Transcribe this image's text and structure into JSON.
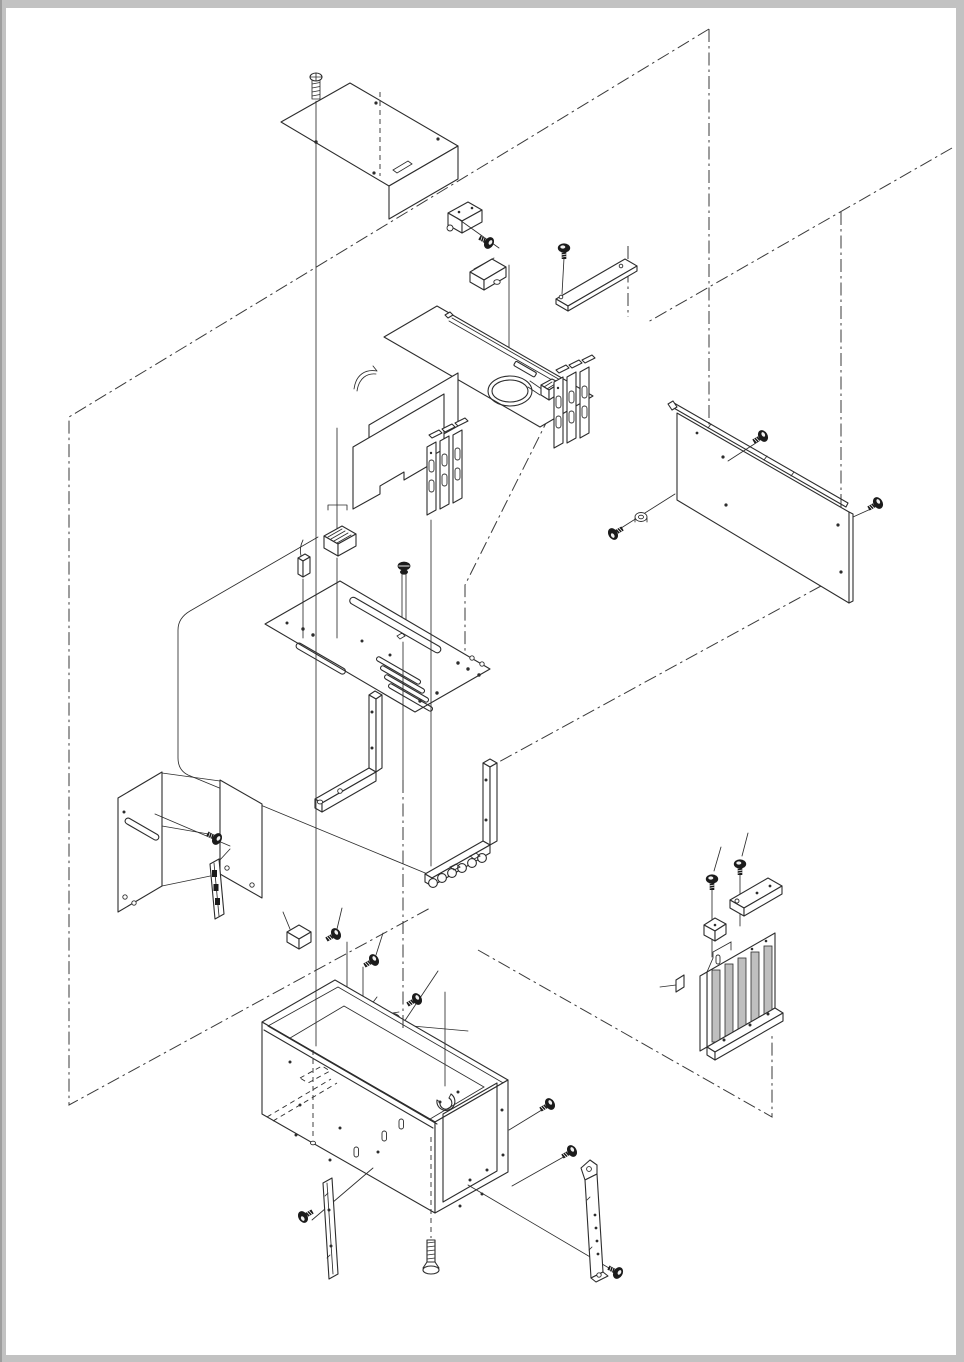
{
  "document": {
    "kind": "exploded-assembly-parts-diagram",
    "description": "black-and-white isometric exploded view of an electronics chassis assembly on a scanned white page",
    "visible_text": [],
    "page": {
      "width": 964,
      "height": 1362
    },
    "colors": {
      "page": "#ffffff",
      "margin": "#c2c2c2",
      "margin_edge": "#9e9e9e",
      "line": "#2d2d2d",
      "construction": "#3a3a3a",
      "slot_fill": "#bfbfbf",
      "screw_fill": "#1b1b1b"
    }
  },
  "parts": [
    {
      "id": "top-cover-screw",
      "name": "flat-head screw above top cover"
    },
    {
      "id": "top-cover-panel",
      "name": "top cover panel with bent flange"
    },
    {
      "id": "hinge-bracket",
      "name": "small hinge bracket with screw"
    },
    {
      "id": "small-cover-cap",
      "name": "small cover cap with grommet hole"
    },
    {
      "id": "top-rail-bracket",
      "name": "long angle rail with screw"
    },
    {
      "id": "right-side-panel",
      "name": "right side cover panel with edge rail and three screws"
    },
    {
      "id": "main-controller-board",
      "name": "controller board panel with cable loop"
    },
    {
      "id": "rear-slot-brackets",
      "name": "three rear connector slot brackets"
    },
    {
      "id": "expansion-cards",
      "name": "two expansion cards with slot brackets"
    },
    {
      "id": "ribbon-cable-connector",
      "name": "ribbon cable plug with pull tab"
    },
    {
      "id": "two-pin-connector",
      "name": "small two-pin connector"
    },
    {
      "id": "long-mount-screw",
      "name": "long mounting screw"
    },
    {
      "id": "slotted-base-tray",
      "name": "slotted mounting tray"
    },
    {
      "id": "left-angle-bracket",
      "name": "left L-shaped support bracket"
    },
    {
      "id": "right-angle-bracket",
      "name": "right L-shaped support bracket with cable chain"
    },
    {
      "id": "left-mount-bracket",
      "name": "left wall mounting bracket with screw"
    },
    {
      "id": "clip-rail-strip",
      "name": "clip rail strip"
    },
    {
      "id": "spacer-block",
      "name": "small spacer block"
    },
    {
      "id": "cable-clamp",
      "name": "half-round cable clamp with screw"
    },
    {
      "id": "connector-holder-plate",
      "name": "connector holder plate"
    },
    {
      "id": "dc-power-connector",
      "name": "DC power connector with barrel plug"
    },
    {
      "id": "main-chassis-box",
      "name": "open chassis box with rear cutout"
    },
    {
      "id": "cable-hook",
      "name": "C-shaped cable hook"
    },
    {
      "id": "chassis-side-screws",
      "name": "two chassis side screws"
    },
    {
      "id": "rear-support-bracket",
      "name": "rear support bracket with screw"
    },
    {
      "id": "front-trim-strip",
      "name": "front trim strip with screw"
    },
    {
      "id": "chassis-bottom-screw",
      "name": "long bottom screw"
    },
    {
      "id": "guide-bracket-assembly",
      "name": "slotted guide bracket with screws, spacer block, clamp bar and pin"
    }
  ]
}
